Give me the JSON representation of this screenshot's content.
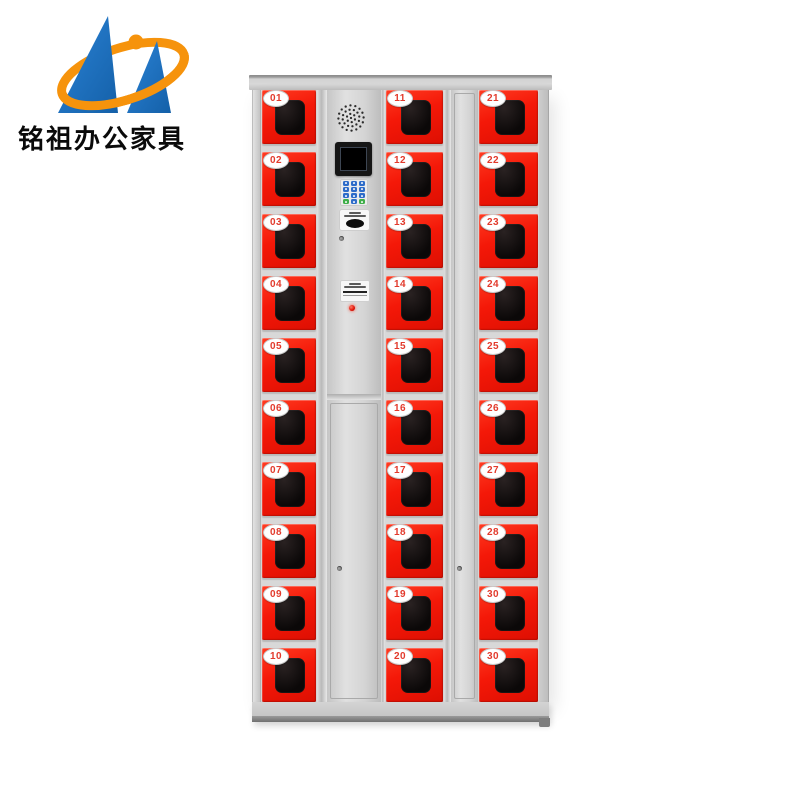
{
  "brand": {
    "name_text": "铭祖办公家具"
  },
  "cabinet": {
    "columns": [
      {
        "id": "left",
        "doors": [
          "01",
          "02",
          "03",
          "04",
          "05",
          "06",
          "07",
          "08",
          "09",
          "10"
        ]
      },
      {
        "id": "middle",
        "doors": [
          "11",
          "12",
          "13",
          "14",
          "15",
          "16",
          "17",
          "18",
          "19",
          "20"
        ]
      },
      {
        "id": "right",
        "doors": [
          "21",
          "22",
          "23",
          "24",
          "25",
          "26",
          "27",
          "28",
          "30",
          "30"
        ]
      }
    ],
    "console": {
      "keys": [
        [
          "blue",
          "blue",
          "blue"
        ],
        [
          "blue",
          "blue",
          "blue"
        ],
        [
          "blue",
          "blue",
          "blue"
        ],
        [
          "green",
          "blue",
          "green"
        ]
      ]
    }
  },
  "colors": {
    "door_red": "#f21807",
    "badge_number": "#e23a2c",
    "logo_blue": "#1e6fbe",
    "logo_orange": "#f6930c",
    "cabinet_gray": "#d4d4d4",
    "screen_black": "#0a0a0a",
    "led_red": "#e01005"
  }
}
